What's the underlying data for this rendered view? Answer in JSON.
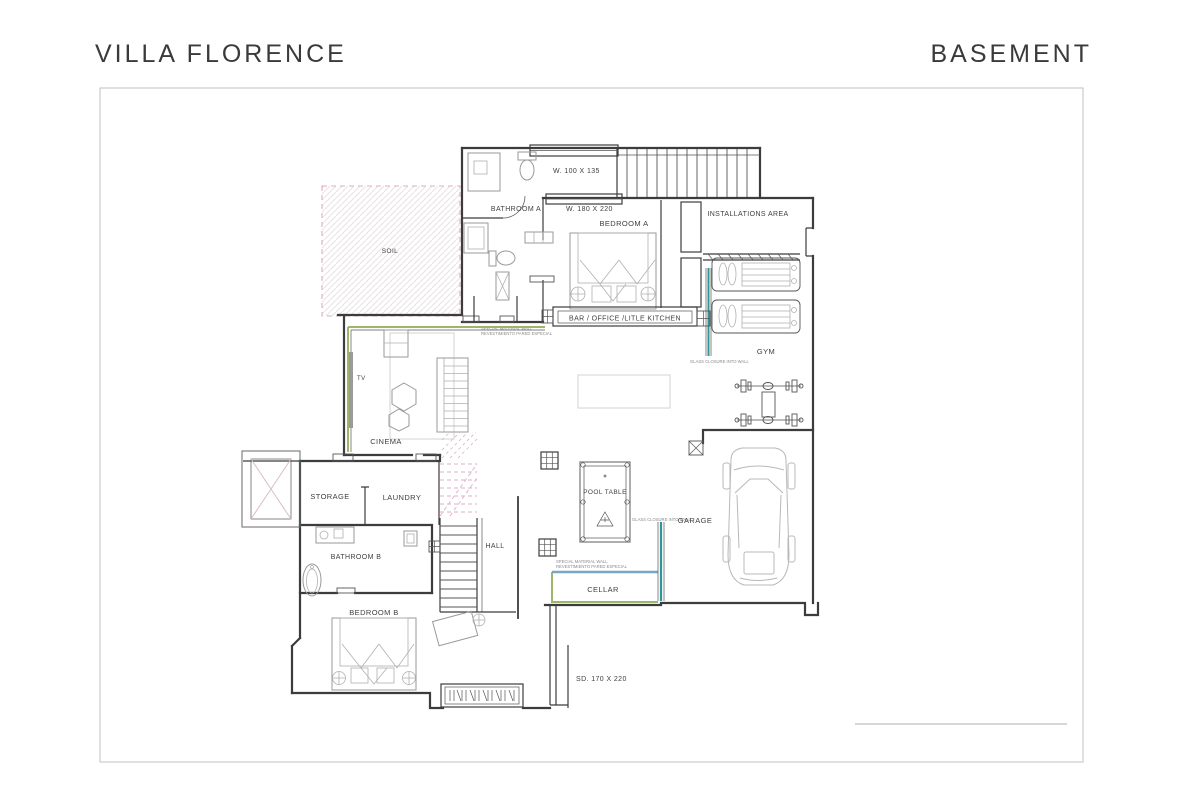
{
  "header": {
    "title": "VILLA FLORENCE",
    "sheet": "BASEMENT"
  },
  "rooms": {
    "soil": "SOIL",
    "bathroom_a": "BATHROOM A",
    "bedroom_a": "BEDROOM A",
    "installations": "INSTALLATIONS AREA",
    "bar": "BAR / OFFICE /LITLE KITCHEN",
    "gym": "GYM",
    "tv": "TV",
    "cinema": "CINEMA",
    "storage": "STORAGE",
    "laundry": "LAUNDRY",
    "bathroom_b": "BATHROOM B",
    "hall": "HALL",
    "pool_table": "POOL TABLE",
    "garage": "GARAGE",
    "cellar": "CELLAR",
    "bedroom_b": "BEDROOM B"
  },
  "windows": {
    "w1": "W. 100 X 135",
    "w2": "W. 180 X 220",
    "sd": "SD. 170 X 220"
  },
  "annotations": {
    "glass_gym": "GLASS CLOSURE INTO WALL",
    "glass_garage": "GLASS CLOSURE INTO WALL",
    "special_bar_en": "SPECIAL MATERIAL WALL",
    "special_bar_es": "REVESTIMIENTO PARED ESPECIAL",
    "special_cellar_en": "SPECIAL MATERIAL WALL",
    "special_cellar_es": "REVESTIMIENTO PARED ESPECIAL"
  },
  "colors": {
    "wall": "#3c3c3c",
    "special_wall_green": "#9cb767",
    "glass_teal": "#2f9598",
    "cellar_blue": "#7aa6c2",
    "stairs_pink": "#dfaec7",
    "soil_hatch": "#eadfe5",
    "furniture_gray": "#a9a9a9",
    "frame_gray": "#c2c2c2"
  }
}
